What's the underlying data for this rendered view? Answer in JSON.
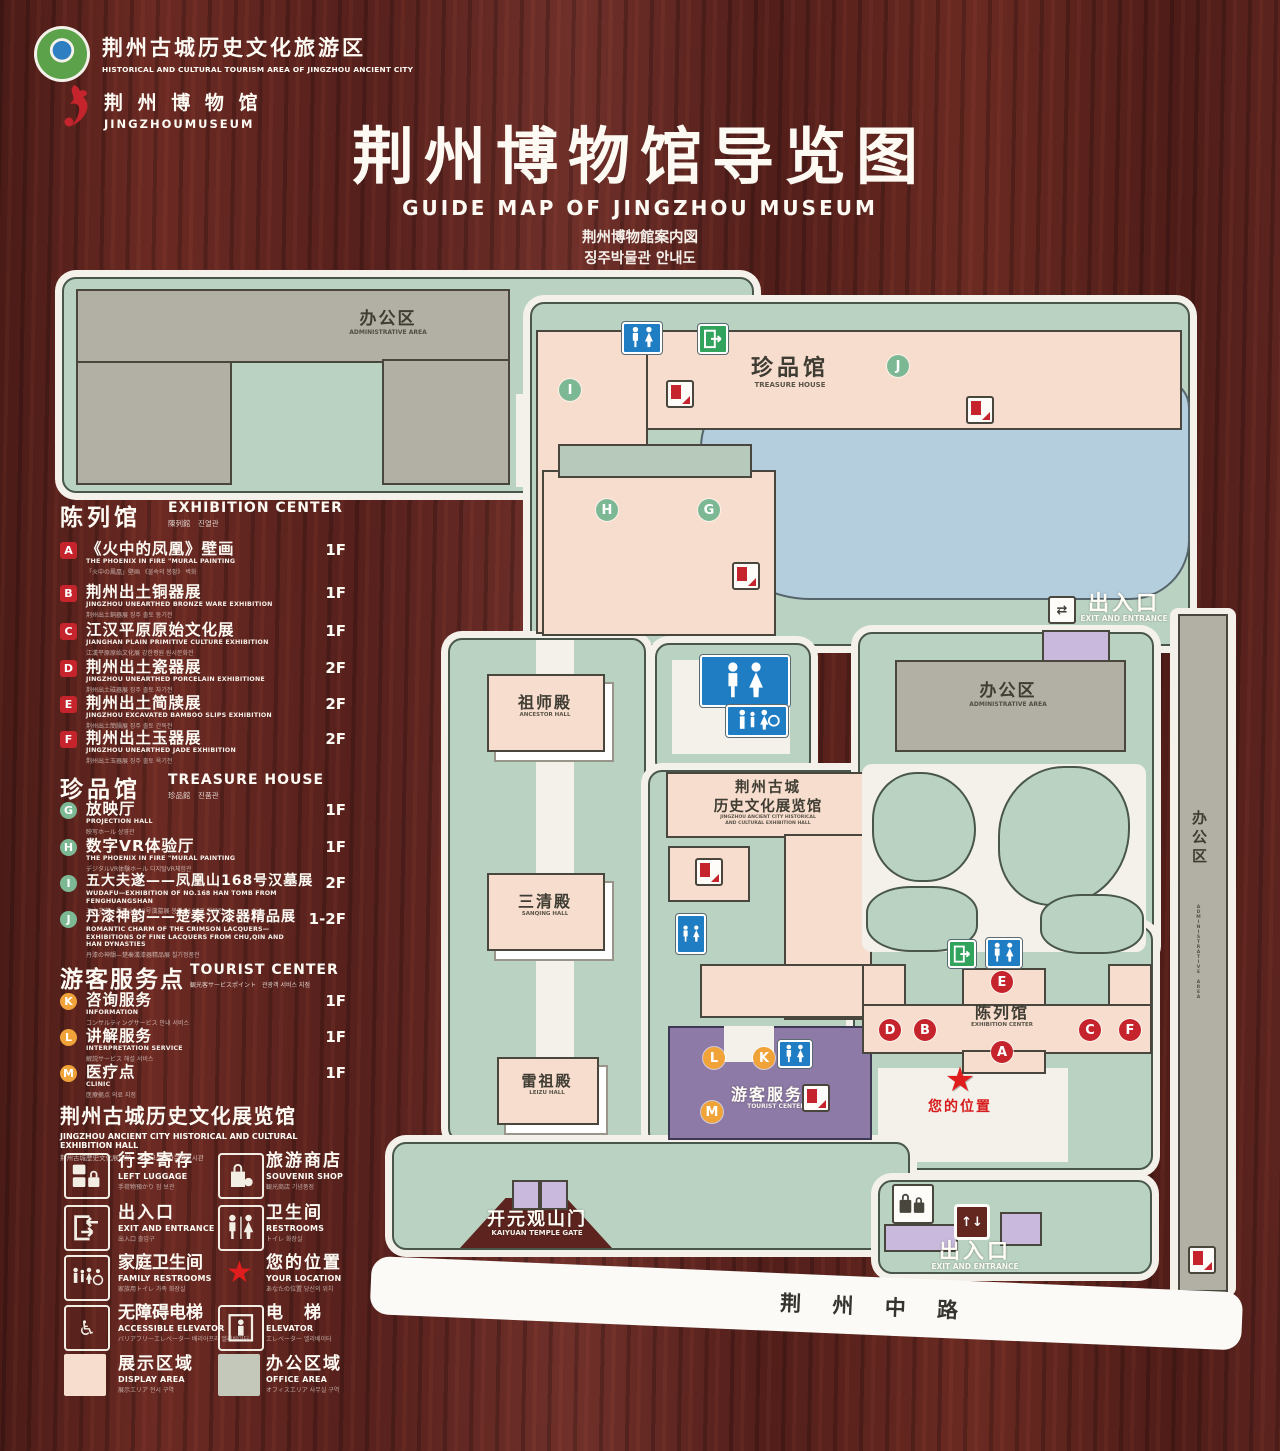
{
  "header": {
    "logo1_cn": "荆州古城历史文化旅游区",
    "logo1_en": "HISTORICAL AND CULTURAL TOURISM AREA OF JINGZHOU ANCIENT CITY",
    "logo2_cn": "荆 州 博 物 馆",
    "logo2_en": "JINGZHOUMUSEUM",
    "title": "荆州博物馆导览图",
    "subtitle_en": "GUIDE MAP OF JINGZHOU MUSEUM",
    "subtitle_jp": "荆州博物館案内図",
    "subtitle_kr": "징주박물관 안내도"
  },
  "legend": {
    "sections": [
      {
        "title_cn": "陈列馆",
        "title_en": "EXHIBITION CENTER",
        "title_sub": "陳列館　진열관",
        "items": [
          {
            "letter": "A",
            "cn": "《火中的凤凰》壁画",
            "en": "THE PHOENIX IN FIRE \"MURAL PAINTING",
            "sub": "「火中の鳳凰」壁画 《불속의 봉황》 벽화",
            "floor": "1F"
          },
          {
            "letter": "B",
            "cn": "荆州出土铜器展",
            "en": "JINGZHOU UNEARTHED BRONZE WARE EXHIBITION",
            "sub": "荆州出土銅器展 징주 출토 동기전",
            "floor": "1F"
          },
          {
            "letter": "C",
            "cn": "江汉平原原始文化展",
            "en": "JIANGHAN PLAIN PRIMITIVE CULTURE EXHIBITION",
            "sub": "江漢平原原始文化展 강한평원 원시문화전",
            "floor": "1F"
          },
          {
            "letter": "D",
            "cn": "荆州出土瓷器展",
            "en": "JINGZHOU UNEARTHED PORCELAIN EXHIBITIONE",
            "sub": "荆州出土磁器展 징주 출토 자기전",
            "floor": "2F"
          },
          {
            "letter": "E",
            "cn": "荆州出土简牍展",
            "en": "JINGZHOU EXCAVATED BAMBOO SLIPS EXHIBITION",
            "sub": "荆州出土簡牘展 징주 출토 간독전",
            "floor": "2F"
          },
          {
            "letter": "F",
            "cn": "荆州出土玉器展",
            "en": "JINGZHOU UNEARTHED JADE EXHIBITION",
            "sub": "荆州出土玉器展 징주 출토 옥기전",
            "floor": "2F"
          }
        ]
      },
      {
        "title_cn": "珍品馆",
        "title_en": "TREASURE HOUSE",
        "title_sub": "珍品館　진품관",
        "items": [
          {
            "letter": "G",
            "cn": "放映厅",
            "en": "PROJECTION HALL",
            "sub": "映写ホール 상영관",
            "floor": "1F"
          },
          {
            "letter": "H",
            "cn": "数字VR体验厅",
            "en": "THE PHOENIX IN FIRE \"MURAL PAINTING",
            "sub": "デジタルVR体験ホール 디지털VR체험관",
            "floor": "1F"
          },
          {
            "letter": "I",
            "cn": "五大夫遂——凤凰山168号汉墓展",
            "en": "WUDAFU—EXHIBITION OF NO.168 HAN TOMB FROM FENGHUANGSHAN",
            "sub": "五大夫遂—鳳凰山168号漢墓展 봉황산168호 한묘전",
            "floor": "2F"
          },
          {
            "letter": "J",
            "cn": "丹漆神韵——楚秦汉漆器精品展",
            "en": "ROMANTIC CHARM OF THE CRIMSON LACQUERS— EXHIBITIONS OF FINE LACQUERS FROM CHU,QIN AND HAN DYNASTIES",
            "sub": "丹漆の神韻—楚秦漢漆器精品展 칠기정품전",
            "floor": "1-2F"
          }
        ]
      },
      {
        "title_cn": "游客服务点",
        "title_en": "TOURIST CENTER",
        "title_sub": "観光客サービスポイント　관광객 서비스 지점",
        "items": [
          {
            "letter": "K",
            "cn": "咨询服务",
            "en": "INFORMATION",
            "sub": "コンサルティングサービス 안내 서비스",
            "floor": "1F"
          },
          {
            "letter": "L",
            "cn": "讲解服务",
            "en": "INTERPRETATION SERVICE",
            "sub": "解説サービス 해설 서비스",
            "floor": "1F"
          },
          {
            "letter": "M",
            "cn": "医疗点",
            "en": "CLINIC",
            "sub": "医療拠点 의료 지점",
            "floor": "1F"
          }
        ]
      }
    ],
    "hall_note": {
      "cn": "荆州古城历史文化展览馆",
      "en": "JINGZHOU ANCIENT CITY HISTORICAL AND CULTURAL EXHIBITION HALL",
      "sub": "荆州古城歴史文化展示館　징주고성역사문화전시관"
    },
    "icon_items": [
      {
        "cn": "行李寄存",
        "en": "LEFT LUGGAGE",
        "sub": "手荷物預かり 짐 보관"
      },
      {
        "cn": "旅游商店",
        "en": "SOUVENIR SHOP",
        "sub": "観光商店 기념품점"
      },
      {
        "cn": "出入口",
        "en": "EXIT AND ENTRANCE",
        "sub": "出入口 출입구"
      },
      {
        "cn": "卫生间",
        "en": "RESTROOMS",
        "sub": "トイレ 화장실"
      },
      {
        "cn": "家庭卫生间",
        "en": "FAMILY RESTROOMS",
        "sub": "家族用トイレ 가족 화장실"
      },
      {
        "cn": "您的位置",
        "en": "YOUR LOCATION",
        "sub": "あなたの位置 당신의 위치"
      },
      {
        "cn": "无障碍电梯",
        "en": "ACCESSIBLE ELEVATOR",
        "sub": "バリアフリーエレベーター 배리어프리 엘리베이터"
      },
      {
        "cn": "电　梯",
        "en": "ELEVATOR",
        "sub": "エレベーター 엘리베이터"
      },
      {
        "cn": "展示区域",
        "en": "DISPLAY AREA",
        "sub": "展示エリア 전시 구역"
      },
      {
        "cn": "办公区域",
        "en": "OFFICE AREA",
        "sub": "オフィスエリア 사무실 구역"
      }
    ]
  },
  "map": {
    "office_nw": {
      "cn": "办公区",
      "en": "ADMINISTRATIVE AREA"
    },
    "treasure": {
      "cn": "珍品馆",
      "en": "TREASURE HOUSE"
    },
    "ancestor": {
      "cn": "祖师殿",
      "en": "ANCESTOR HALL"
    },
    "sanqing": {
      "cn": "三清殿",
      "en": "SANQING HALL"
    },
    "leizu": {
      "cn": "雷祖殿",
      "en": "LEIZU HALL"
    },
    "exh_hall": {
      "cn1": "荆州古城",
      "cn2": "历史文化展览馆",
      "en1": "JINGZHOU ANCIENT CITY HISTORICAL",
      "en2": "AND CULTURAL EXHIBITION HALL"
    },
    "tourist": {
      "cn": "游客服务点",
      "en": "TOURIST CENTER"
    },
    "office_e": {
      "cn": "办公区",
      "en": "ADMINISTRATIVE AREA"
    },
    "office_strip": {
      "cn": "办公区",
      "en": "ADMINISTRATIVE AREA"
    },
    "display": {
      "cn": "陈列馆",
      "en": "EXHIBITION CENTER"
    },
    "exit_ne": {
      "cn": "出入口",
      "en": "EXIT AND ENTRANCE"
    },
    "exit_s": {
      "cn": "出入口",
      "en": "EXIT AND ENTRANCE"
    },
    "gate": {
      "cn": "开元观山门",
      "en": "KAIYUAN TEMPLE GATE"
    },
    "road": "荆 州 中 路",
    "your_location": "您的位置",
    "markers": {
      "a": "A",
      "b": "B",
      "c": "C",
      "d": "D",
      "e": "E",
      "f": "F",
      "g": "G",
      "h": "H",
      "i": "I",
      "j": "J",
      "k": "K",
      "l": "L",
      "m": "M"
    }
  },
  "colors": {
    "wood": "#5d241f",
    "land": "#b9d2c2",
    "building_pink": "#f7ddcd",
    "building_gray": "#b2b0a4",
    "pond": "#b4cedd",
    "tourist_purple": "#8d7aa6",
    "gate_purple": "#c9badd",
    "marker_red": "#c5242c",
    "marker_green": "#7cb894",
    "marker_orange": "#f0a339",
    "restroom_blue": "#1f7dc4",
    "exit_green": "#31a35d",
    "location_red": "#e01d1d"
  }
}
